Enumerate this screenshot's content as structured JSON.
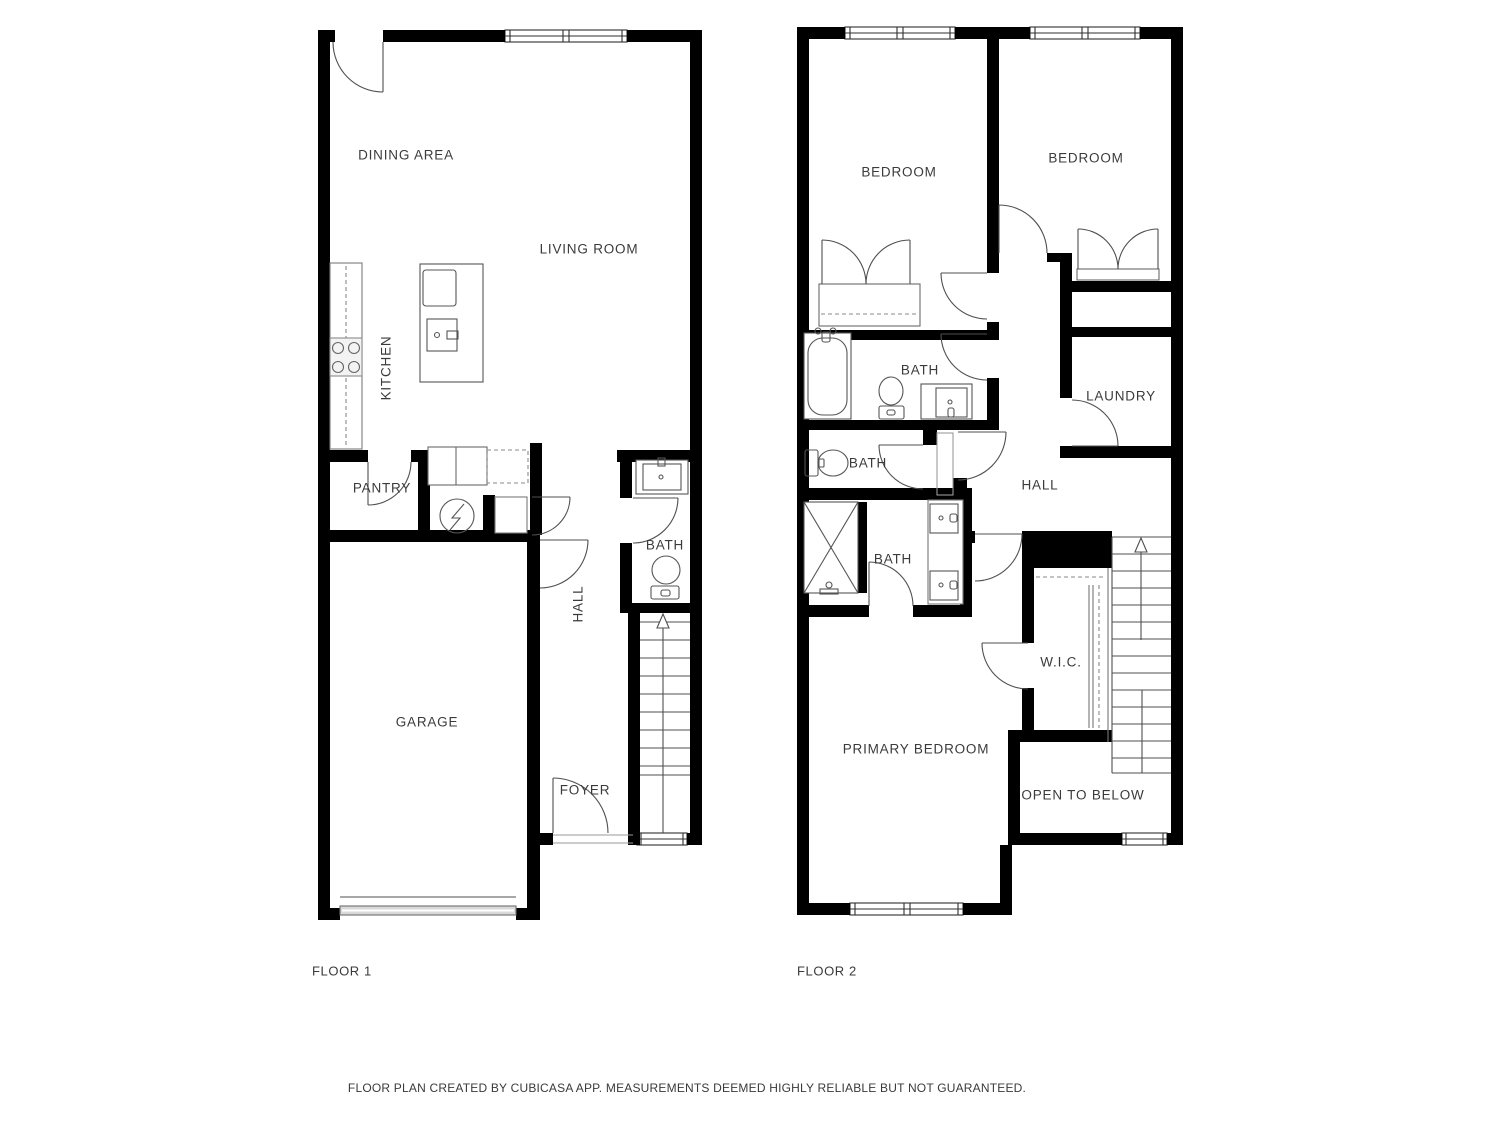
{
  "footer": {
    "disclaimer": "FLOOR PLAN CREATED BY CUBICASA APP. MEASUREMENTS DEEMED HIGHLY RELIABLE BUT NOT GUARANTEED."
  },
  "colors": {
    "wall": "#000000",
    "fixture_line": "#4f4f4f",
    "label_text": "#3b3b3b",
    "garage_door": "#8a8a8a"
  },
  "floor1": {
    "name": "FLOOR 1",
    "rooms": [
      {
        "label": "DINING AREA"
      },
      {
        "label": "LIVING ROOM"
      },
      {
        "label": "KITCHEN"
      },
      {
        "label": "PANTRY"
      },
      {
        "label": "HALL"
      },
      {
        "label": "BATH"
      },
      {
        "label": "GARAGE"
      },
      {
        "label": "FOYER"
      }
    ]
  },
  "floor2": {
    "name": "FLOOR 2",
    "rooms": [
      {
        "label": "BEDROOM"
      },
      {
        "label": "BEDROOM"
      },
      {
        "label": "BATH"
      },
      {
        "label": "LAUNDRY"
      },
      {
        "label": "BATH"
      },
      {
        "label": "HALL"
      },
      {
        "label": "BATH"
      },
      {
        "label": "W.I.C."
      },
      {
        "label": "PRIMARY BEDROOM"
      },
      {
        "label": "OPEN TO BELOW"
      }
    ]
  }
}
